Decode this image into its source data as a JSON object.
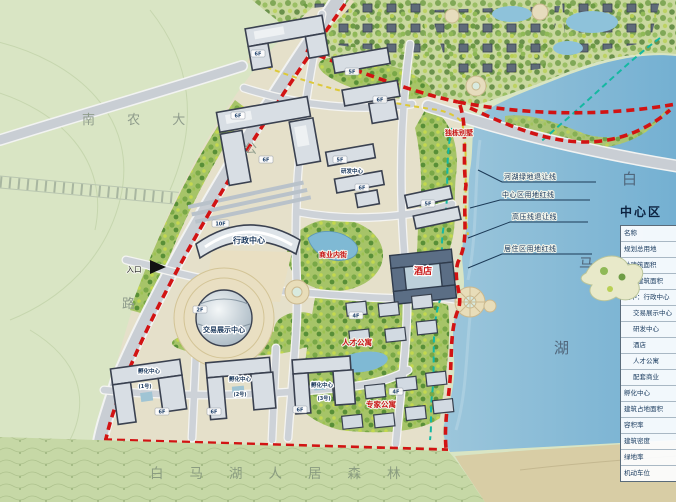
{
  "regions": {
    "university": "南 农 大",
    "highway_char_top": "公",
    "highway_char_bottom": "路",
    "forest_belt": "白马湖人居森林",
    "lake_name_chars": [
      "白",
      "马",
      "湖"
    ],
    "entrance": "入口"
  },
  "callouts": {
    "river_green_setback": "河湖绿地退让线",
    "center_red_line": "中心区用地红线",
    "hv_line_setback": "高压线退让线",
    "residential_red_line": "居住区用地红线"
  },
  "floors": {
    "f10": "10F",
    "f6": "6F",
    "f5": "5F",
    "f4": "4F",
    "f2": "2F"
  },
  "buildings": {
    "admin_name": "行政中心",
    "expo_name": "交易展示中心",
    "rnd_name": "研发中心",
    "hotel_name": "酒店",
    "commercial_street": "商业内街",
    "apartments_a": "人才公寓",
    "apartments_b": "专家公寓",
    "villas": "独栋别墅",
    "incubator_name": "孵化中心",
    "incubator_no1": "(1号)",
    "incubator_no2": "(2号)",
    "incubator_no3": "(3号)"
  },
  "legend": {
    "title": "中心区",
    "rows": [
      "名称",
      "规划总用地",
      "总建筑面积",
      "地上建筑面积",
      "其中：行政中心",
      "交易展示中心",
      "研发中心",
      "酒店",
      "人才公寓",
      "配套商业",
      "孵化中心",
      "建筑占地面积",
      "容积率",
      "建筑密度",
      "绿地率",
      "机动车位"
    ]
  }
}
